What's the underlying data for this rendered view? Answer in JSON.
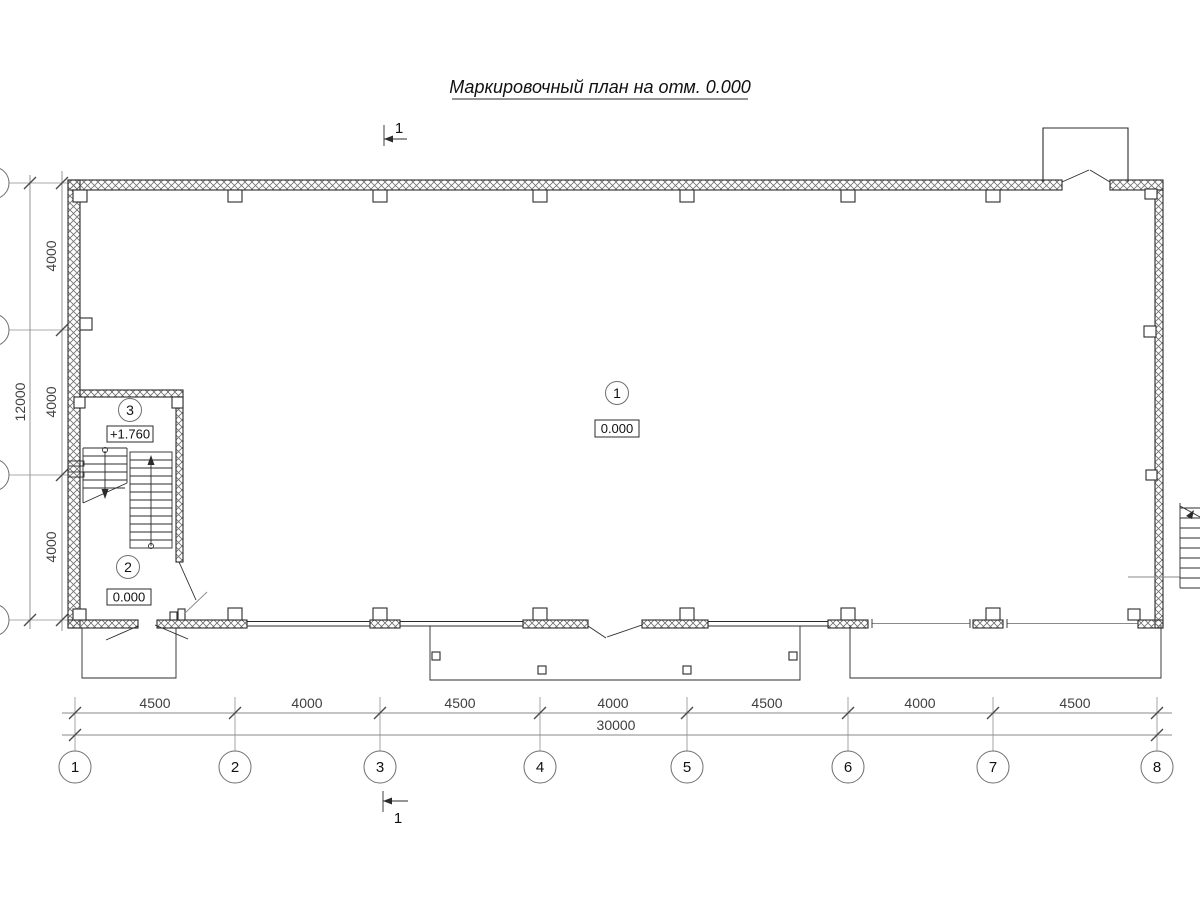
{
  "title": "Маркировочный план на отм. 0.000",
  "section": {
    "top_label": "1",
    "bottom_label": "1"
  },
  "grid": {
    "bottom_axes": [
      "1",
      "2",
      "3",
      "4",
      "5",
      "6",
      "7",
      "8"
    ],
    "bottom_dims": [
      "4500",
      "4000",
      "4500",
      "4000",
      "4500",
      "4000",
      "4500"
    ],
    "bottom_total": "30000",
    "left_dims": [
      "4000",
      "4000",
      "4000"
    ],
    "left_total": "12000"
  },
  "rooms": [
    {
      "number": "1",
      "elevation": "0.000"
    },
    {
      "number": "2",
      "elevation": "0.000"
    },
    {
      "number": "3",
      "elevation": "+1.760"
    }
  ]
}
